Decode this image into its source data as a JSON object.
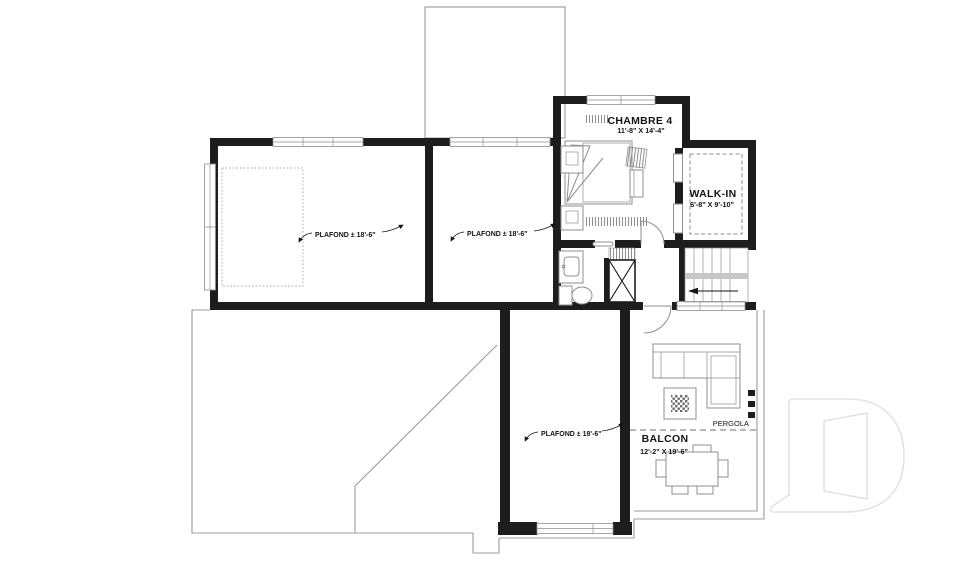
{
  "labels": {
    "chambre4": {
      "name": "CHAMBRE 4",
      "dims": "11'-8\" X 14'-4\""
    },
    "walkin": {
      "name": "WALK-IN",
      "dims": "6'-8\" X 9'-10\""
    },
    "balcon": {
      "name": "BALCON",
      "dims": "12'-2\" X 19'-6\""
    },
    "pergola": "PERGOLA",
    "ceiling_note": "PLAFOND ± 18'-6\""
  },
  "colors": {
    "wall": "#1d1d1d",
    "furniture_line": "#8f8f8f",
    "roof_line": "#9c9c9c",
    "text": "#141414",
    "watermark": "#e3e3e3"
  }
}
